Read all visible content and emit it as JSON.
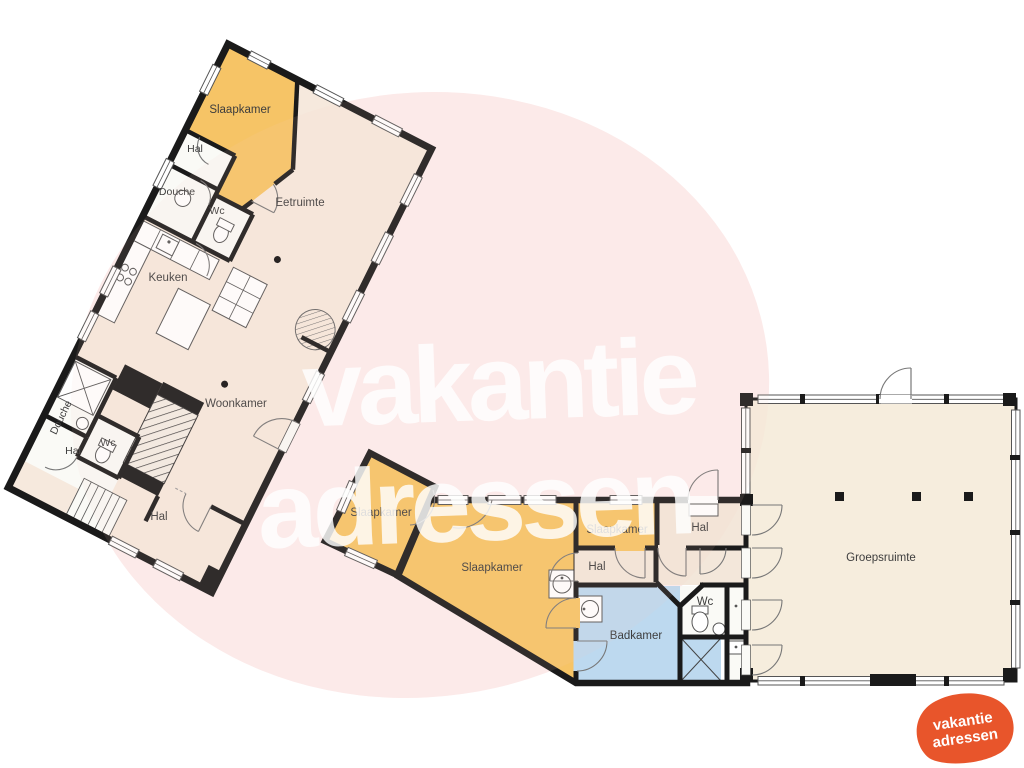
{
  "watermark": {
    "word1": "vakantie",
    "word2": "adressen",
    "ellipse_color": "#fdeeee",
    "text_color": "#ffffff"
  },
  "logo": {
    "word1": "vakantie",
    "word2": "adressen",
    "blob_color": "#e8552b",
    "text_color": "#ffffff"
  },
  "legend_colors": {
    "bedroom_orange": "#f6c466",
    "living_beige": "#f6e9dd",
    "bathroom_blue": "#bdd9ef",
    "sanitary_white": "#fafaf6",
    "wall_black": "#1a1a1a"
  },
  "floorplan": {
    "building_left": {
      "rooms": {
        "slaapkamer": "Slaapkamer",
        "hal_top": "Hal",
        "douche_top": "Douche",
        "wc_top": "Wc",
        "eetruimte": "Eetruimte",
        "keuken": "Keuken",
        "woonkamer": "Woonkamer",
        "douche_bottom": "Douche",
        "wc_bottom": "Wc",
        "hal_mid": "Hal",
        "hal_bottom": "Hal"
      }
    },
    "building_bottom": {
      "rooms": {
        "slaapkamer_west": "Slaapkamer",
        "slaapkamer_main": "Slaapkamer",
        "slaapkamer_east": "Slaapkamer",
        "hal_east": "Hal",
        "hal_mid": "Hal",
        "wc": "Wc",
        "badkamer": "Badkamer"
      }
    },
    "building_right": {
      "rooms": {
        "groepsruimte": "Groepsruimte"
      }
    }
  }
}
